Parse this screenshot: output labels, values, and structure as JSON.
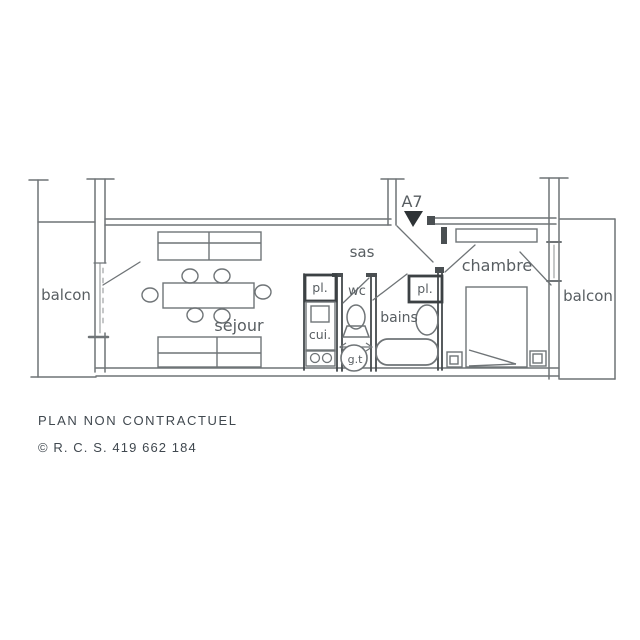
{
  "plan": {
    "entrance": {
      "label": "A7"
    },
    "rooms": {
      "balcon_left": {
        "label": "balcon"
      },
      "sejour": {
        "label": "séjour"
      },
      "sas": {
        "label": "sas"
      },
      "closet_kitchen": {
        "label": "pl."
      },
      "cuisine": {
        "label": "cui."
      },
      "wc": {
        "label": "wc"
      },
      "gaine_technique": {
        "label": "g.t"
      },
      "bains": {
        "label": "bains"
      },
      "closet_bains": {
        "label": "pl."
      },
      "chambre": {
        "label": "chambre"
      },
      "balcon_right": {
        "label": "balcon"
      }
    }
  },
  "footer": {
    "disclaimer": "PLAN NON CONTRACTUEL",
    "registration": "© R. C. S. 419 662 184"
  },
  "colors": {
    "wall_line": "#6f7477",
    "partition_dark": "#3c4144",
    "label_text": "#585e62",
    "footer_text": "#40484f",
    "background": "#ffffff"
  }
}
